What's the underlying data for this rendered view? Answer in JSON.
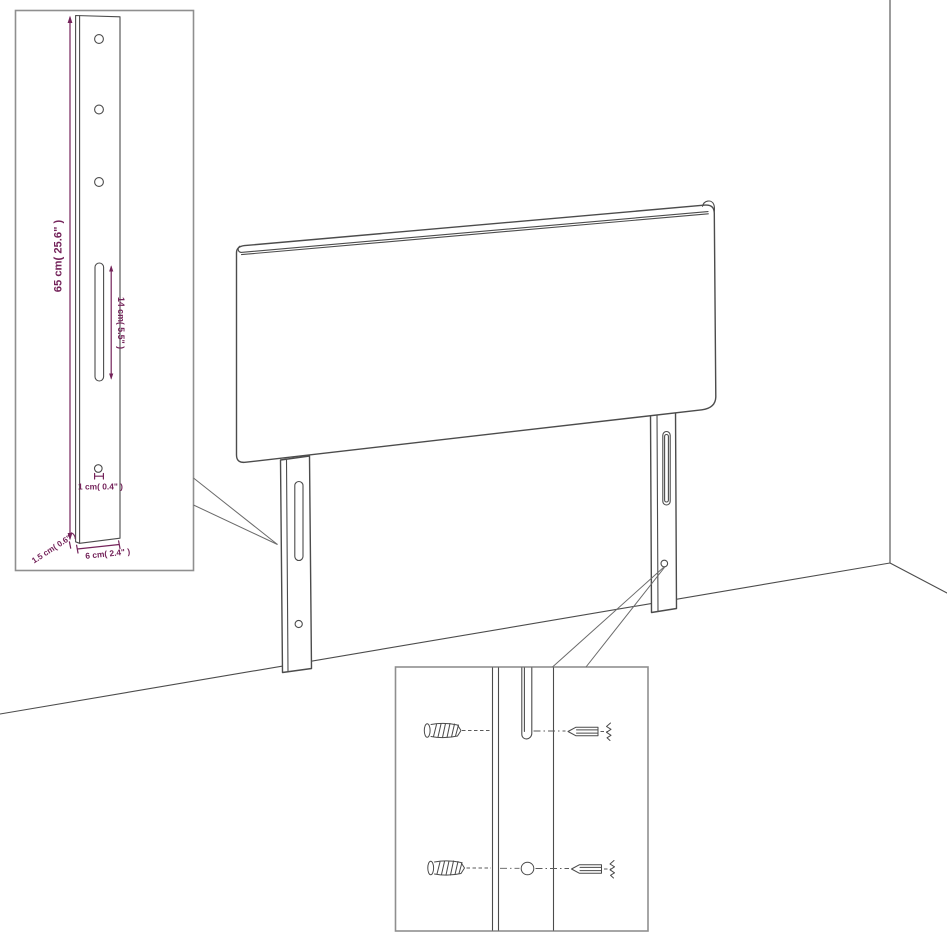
{
  "colors": {
    "background": "#ffffff",
    "drawing_outline": "#4c4c4c",
    "inset_border": "#8f8f8f",
    "dimension_accent": "#74235a"
  },
  "insets": {
    "dimensions": {
      "height_label": "65 cm( 25.6\" )",
      "slot_label": "14 cm( 5.5\" )",
      "hole_label": "1 cm( 0.4\" )",
      "width_label": "6 cm( 2.4\" )",
      "depth_label": "1.5 cm( 0.6\" )",
      "bracket_hole_count": 3
    },
    "hardware": {
      "screw_count": 2,
      "wall_plug_count": 2,
      "hole_count": 1,
      "slot_count": 1
    }
  }
}
